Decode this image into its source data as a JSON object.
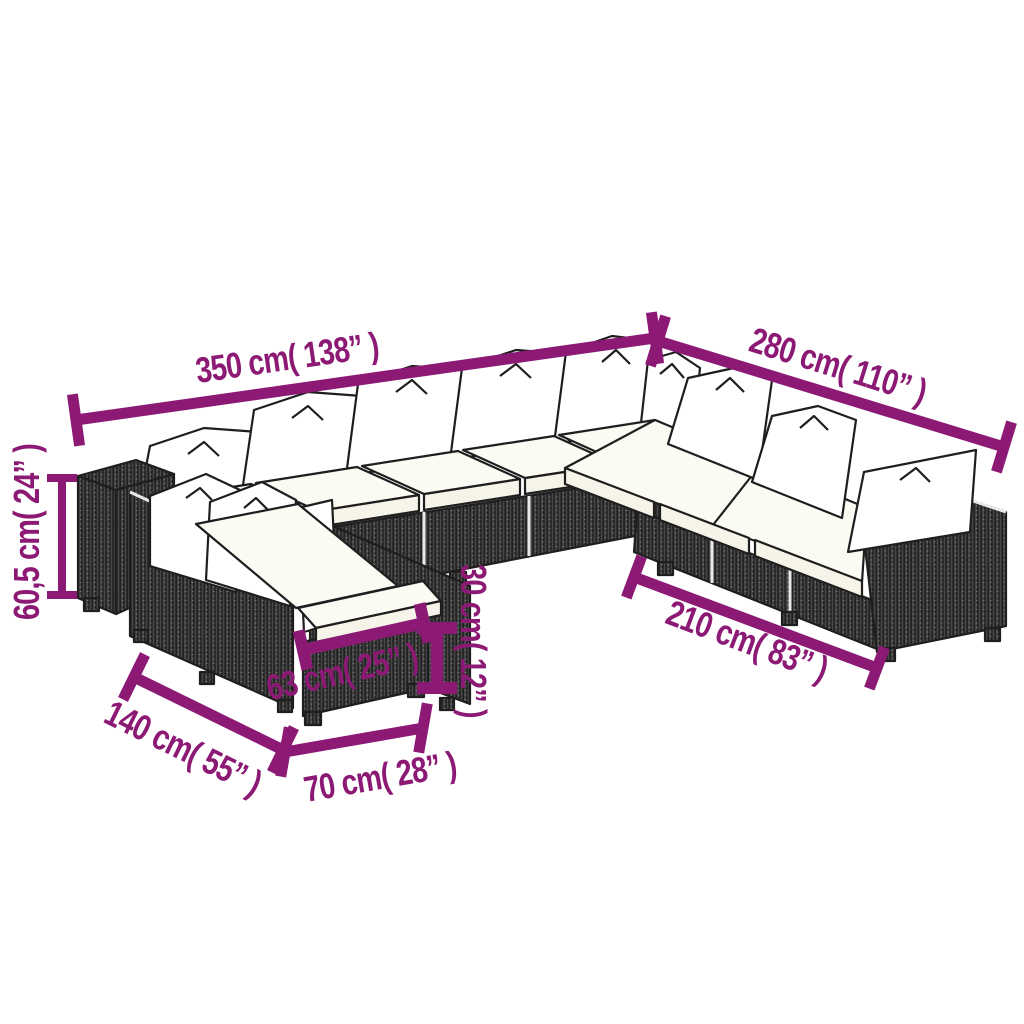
{
  "title": "Garden sofa set dimension diagram",
  "accent_color": "#8c1a75",
  "artwork": "poly rattan corner sofa set with cushions, ottoman and chaise",
  "dims": {
    "back_width": {
      "label": "350 cm( 138” )",
      "cm": "350",
      "inch": "138"
    },
    "right_depth": {
      "label": "280 cm( 110” )",
      "cm": "280",
      "inch": "110"
    },
    "height": {
      "label": "60,5 cm( 24” )",
      "cm": "60,5",
      "inch": "24"
    },
    "front_right_width": {
      "label": "210 cm( 83” )",
      "cm": "210",
      "inch": "83"
    },
    "ottoman_width": {
      "label": "63 cm( 25” )",
      "cm": "63",
      "inch": "25"
    },
    "ottoman_height": {
      "label": "30 cm( 12” )",
      "cm": "30",
      "inch": "12"
    },
    "chaise_depth": {
      "label": "140 cm( 55” )",
      "cm": "140",
      "inch": "55"
    },
    "ottoman_front_width": {
      "label": "70 cm( 28” )",
      "cm": "70",
      "inch": "28"
    }
  }
}
